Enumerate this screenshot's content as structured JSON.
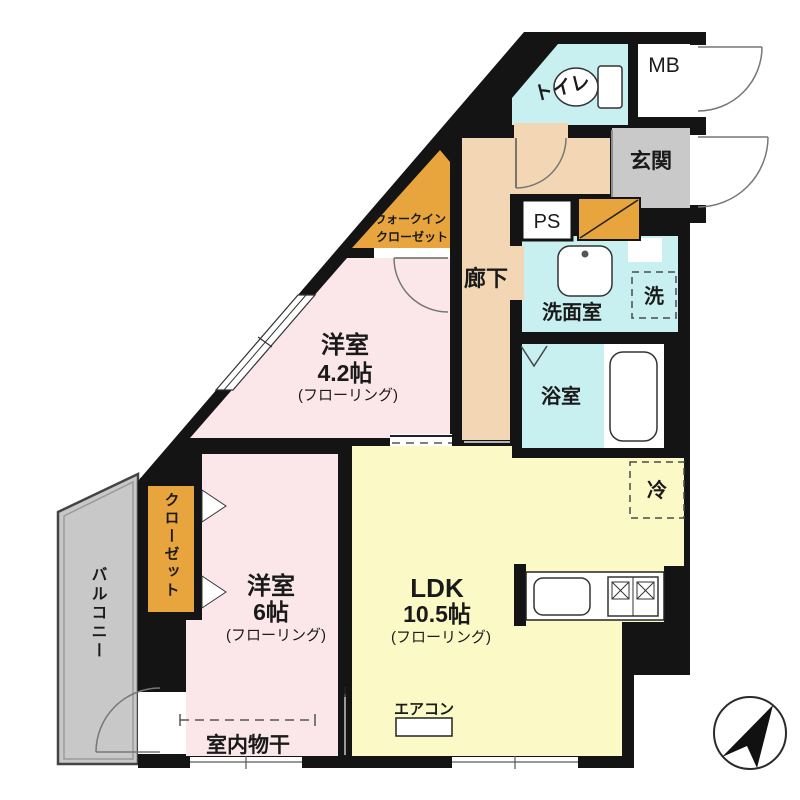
{
  "colors": {
    "wall": "#141414",
    "room_pink": "#fbe7e9",
    "room_yellow": "#fbfac7",
    "wet_cyan": "#c9f0f0",
    "hallway_peach": "#f3d6b4",
    "entrance_gray": "#c9c9c9",
    "closet_orange": "#e8a43d",
    "balcony_gray": "#c8c8c8"
  },
  "rooms": {
    "toilet": {
      "label": "トイレ"
    },
    "meter_box": {
      "label": "MB"
    },
    "entrance": {
      "label": "玄関"
    },
    "pipe_space": {
      "label": "PS"
    },
    "walk_in_closet": {
      "line1": "ウォークイン",
      "line2": "クローゼット"
    },
    "hallway": {
      "label": "廊下"
    },
    "washroom": {
      "label": "洗面室"
    },
    "washer": {
      "label": "洗"
    },
    "bathroom": {
      "label": "浴室"
    },
    "refrigerator": {
      "label": "冷"
    },
    "bedroom_42": {
      "name": "洋室",
      "size": "4.2帖",
      "flooring": "(フローリング)"
    },
    "bedroom_6": {
      "name": "洋室",
      "size": "6帖",
      "flooring": "(フローリング)"
    },
    "ldk": {
      "name": "LDK",
      "size": "10.5帖",
      "flooring": "(フローリング)"
    },
    "closet": {
      "label": "クローゼット"
    },
    "balcony": {
      "label": "バルコニー"
    },
    "aircon": {
      "label": "エアコン"
    },
    "indoor_drying": {
      "label": "室内物干"
    }
  }
}
